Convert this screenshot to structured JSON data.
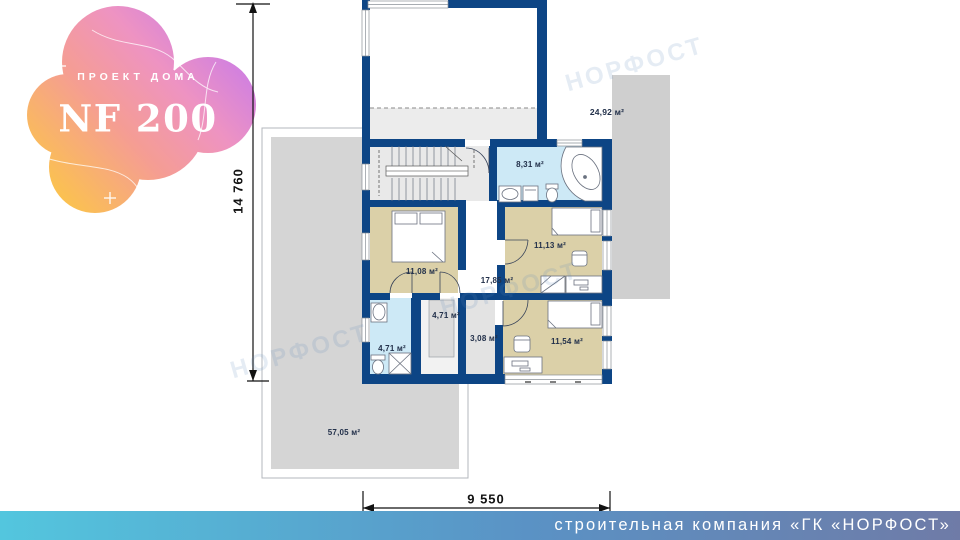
{
  "logo": {
    "subtitle": "ПРОЕКТ ДОМА",
    "title": "NF 200"
  },
  "rooms": {
    "roof_area": "24,92 м²",
    "bathroom_top": "8,31 м²",
    "bedroom_left": "11,08 м²",
    "bedroom_right": "11,13 м²",
    "hall": "17,85 м²",
    "wardrobe": "4,71 м²",
    "bathroom_bottom": "4,71 м²",
    "corridor": "3,08 м²",
    "bedroom_bottom": "11,54 м²",
    "terrace": "57,05 м²"
  },
  "dims": {
    "height_mm": "14 760",
    "width_mm": "9 550"
  },
  "footer": {
    "company": "строительная компания «ГК «НОРФОСТ»"
  },
  "watermark": {
    "text": "НОРФОСТ"
  },
  "colors": {
    "wall": "#0d4585",
    "label": "#22304a",
    "bedroom_floor": "#dbd0a8",
    "bathroom_floor": "#cde9f6",
    "corridor_floor": "#e3e3e3",
    "stairs_floor": "#e9e9e9",
    "terrace_fill": "#d5d5d5",
    "roof_fill": "#cfcfcf",
    "footer_left": "#53c6de",
    "footer_mid": "#5a92c5",
    "footer_right": "#6f7ba7",
    "logo_g0": "#fcc844",
    "logo_g1": "#f59d93",
    "logo_g2": "#ee93c2",
    "logo_g3": "#c97be8"
  }
}
